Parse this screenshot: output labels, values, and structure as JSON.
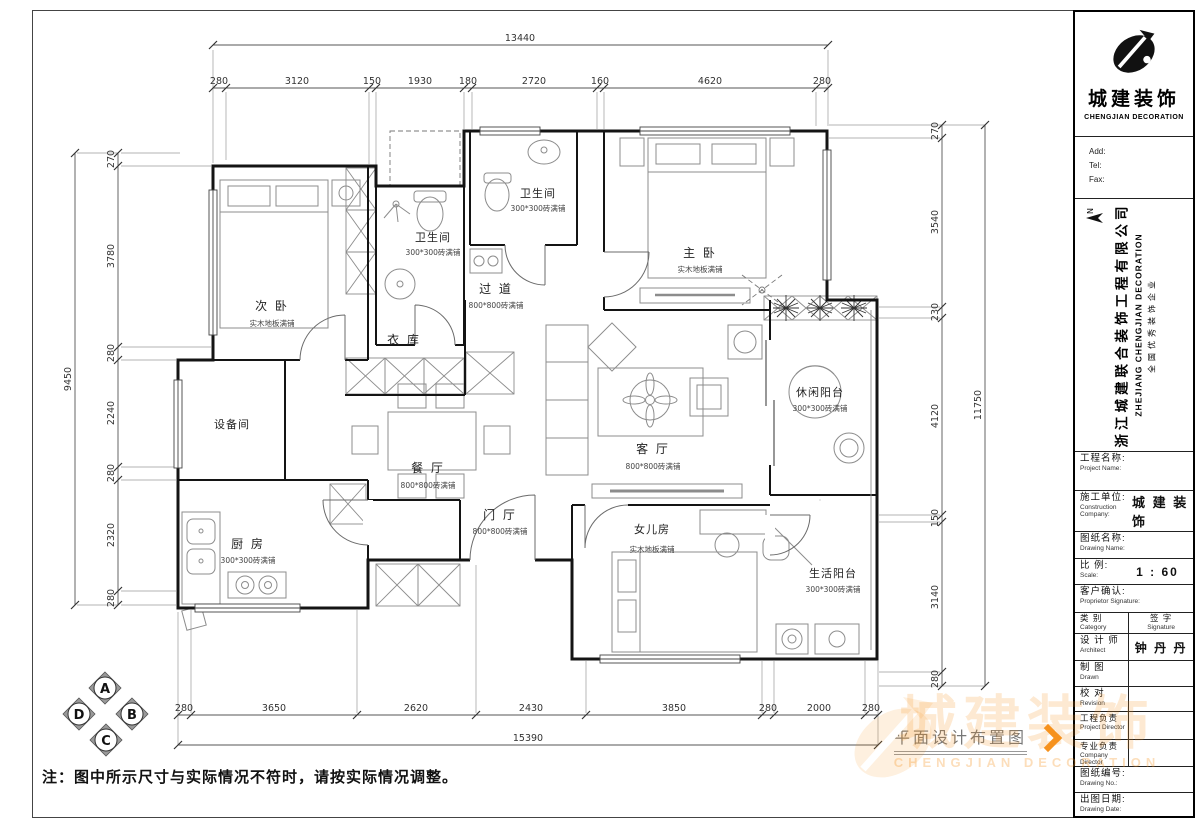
{
  "note": "注：图中所示尺寸与实际情况不符时，请按实际情况调整。",
  "caption": "平面设计布置图",
  "colors": {
    "accent": "#F6921E",
    "wall": "#141414",
    "dim": "#555555"
  },
  "watermark": {
    "cn": "城建装饰",
    "en": "CHENGJIAN DECORATION"
  },
  "titleblock": {
    "brand": {
      "cn": "城建装饰",
      "en": "CHENGJIAN DECORATION"
    },
    "contact": {
      "add": "Add:",
      "tel": "Tel:",
      "fax": "Fax:"
    },
    "company": {
      "cn": "浙江城建联合装饰工程有限公司",
      "en": "ZHEJIANG CHENGJIAN DECORATION",
      "slogan": "全国优秀装饰企业"
    },
    "north_label": "N",
    "fields": {
      "project_name": {
        "cn": "工程名称:",
        "en": "Project Name:"
      },
      "construction": {
        "cn": "施工单位:",
        "en": "Construction Company:",
        "value": "城 建 装 饰"
      },
      "drawing_name": {
        "cn": "图纸名称:",
        "en": "Drawing Name:"
      },
      "scale": {
        "cn": "比 例:",
        "en": "Scale:",
        "value": "1 : 60"
      },
      "proprietor": {
        "cn": "客户确认:",
        "en": "Proprietor Signature:"
      },
      "category": {
        "cn": "类  别",
        "en": "Category"
      },
      "signature": {
        "cn": "签  字",
        "en": "Signature"
      },
      "architect": {
        "cn": "设 计 师",
        "en": "Architect",
        "value": "钟 丹 丹"
      },
      "drawn": {
        "cn": "制  图",
        "en": "Drawn",
        "value": ""
      },
      "revision": {
        "cn": "校  对",
        "en": "Revision",
        "value": ""
      },
      "project_director": {
        "cn": "工程负责",
        "en": "Project Director",
        "value": ""
      },
      "company_director": {
        "cn": "专业负责",
        "en": "Company Director",
        "value": ""
      },
      "drawing_no": {
        "cn": "图纸编号:",
        "en": "Drawing No.:"
      },
      "drawing_date": {
        "cn": "出图日期:",
        "en": "Drawing Date:"
      }
    }
  },
  "plan": {
    "marker": {
      "a": "A",
      "b": "B",
      "c": "C",
      "d": "D"
    },
    "rooms": [
      {
        "name": "次 卧",
        "finish": "实木地板满铺"
      },
      {
        "name": "卫生间",
        "finish": "300*300砖满铺"
      },
      {
        "name": "卫生间",
        "finish": "300*300砖满铺"
      },
      {
        "name": "过 道",
        "finish": "800*800砖满铺"
      },
      {
        "name": "衣 库",
        "finish": ""
      },
      {
        "name": "主 卧",
        "finish": "实木地板满铺"
      },
      {
        "name": "客 厅",
        "finish": "800*800砖满铺"
      },
      {
        "name": "餐 厅",
        "finish": "800*800砖满铺"
      },
      {
        "name": "设备间",
        "finish": ""
      },
      {
        "name": "厨 房",
        "finish": "300*300砖满铺"
      },
      {
        "name": "门 厅",
        "finish": "800*800砖满铺"
      },
      {
        "name": "女儿房",
        "finish": "实木地板满铺"
      },
      {
        "name": "休闲阳台",
        "finish": "300*300砖满铺"
      },
      {
        "name": "生活阳台",
        "finish": "300*300砖满铺"
      }
    ],
    "dims": {
      "top": {
        "total": "13440",
        "segments": [
          "280",
          "3120",
          "150",
          "1930",
          "180",
          "2720",
          "160",
          "4620",
          "280"
        ]
      },
      "left": {
        "total": "9450",
        "segments": [
          "270",
          "3780",
          "280",
          "2240",
          "280",
          "2320",
          "280"
        ]
      },
      "right": {
        "total": "11750",
        "segments": [
          "270",
          "3540",
          "230",
          "4120",
          "150",
          "3140",
          "280"
        ]
      },
      "bottom": {
        "total": "15390",
        "segments": [
          "280",
          "3650",
          "2620",
          "2430",
          "3850",
          "280",
          "2000",
          "280"
        ]
      }
    }
  }
}
